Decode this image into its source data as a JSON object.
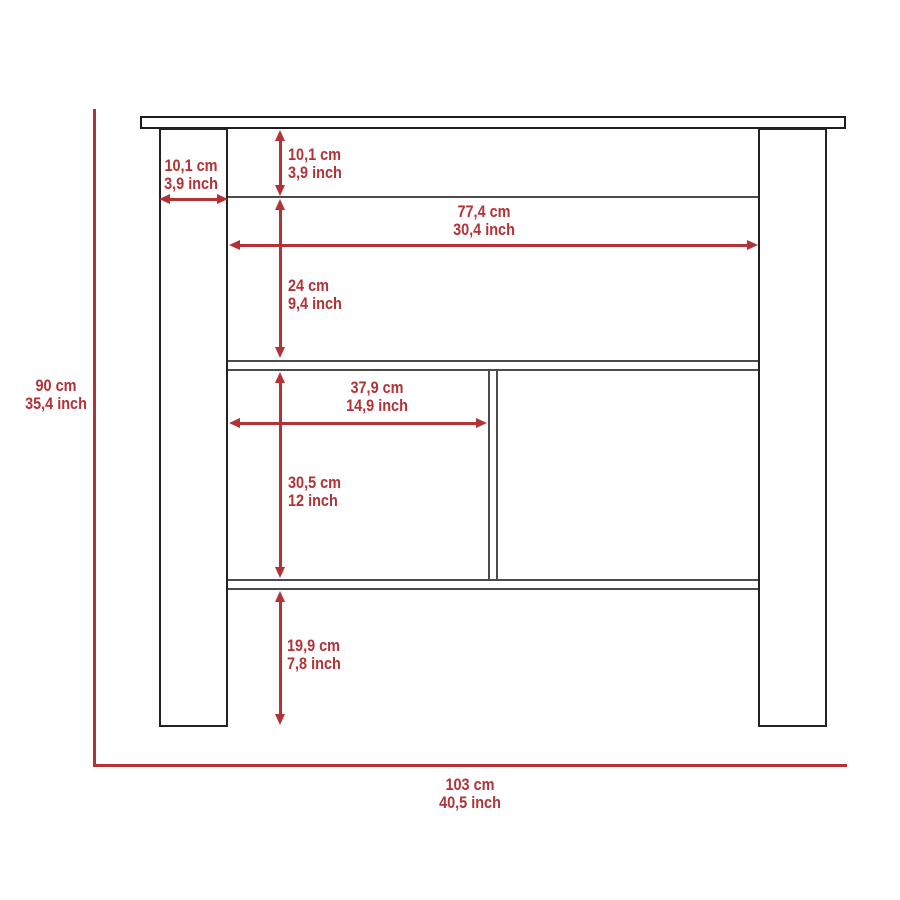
{
  "diagram": {
    "type": "furniture-dimension-drawing",
    "dimensions": {
      "overall_height": {
        "cm": "90 cm",
        "inch": "35,4 inch"
      },
      "overall_width": {
        "cm": "103 cm",
        "inch": "40,5 inch"
      },
      "leg_width": {
        "cm": "10,1 cm",
        "inch": "3,9 inch"
      },
      "top_rail_height": {
        "cm": "10,1 cm",
        "inch": "3,9 inch"
      },
      "inner_width": {
        "cm": "77,4 cm",
        "inch": "30,4 inch"
      },
      "upper_opening_height": {
        "cm": "24 cm",
        "inch": "9,4 inch"
      },
      "left_compartment_width": {
        "cm": "37,9 cm",
        "inch": "14,9 inch"
      },
      "compartment_height": {
        "cm": "30,5 cm",
        "inch": "12 inch"
      },
      "bottom_clearance": {
        "cm": "19,9 cm",
        "inch": "7,8 inch"
      }
    },
    "colors": {
      "dimension_red": "#b23236",
      "line_dark": "#222222",
      "line_gray": "#4c4c4c",
      "background": "#ffffff"
    }
  }
}
